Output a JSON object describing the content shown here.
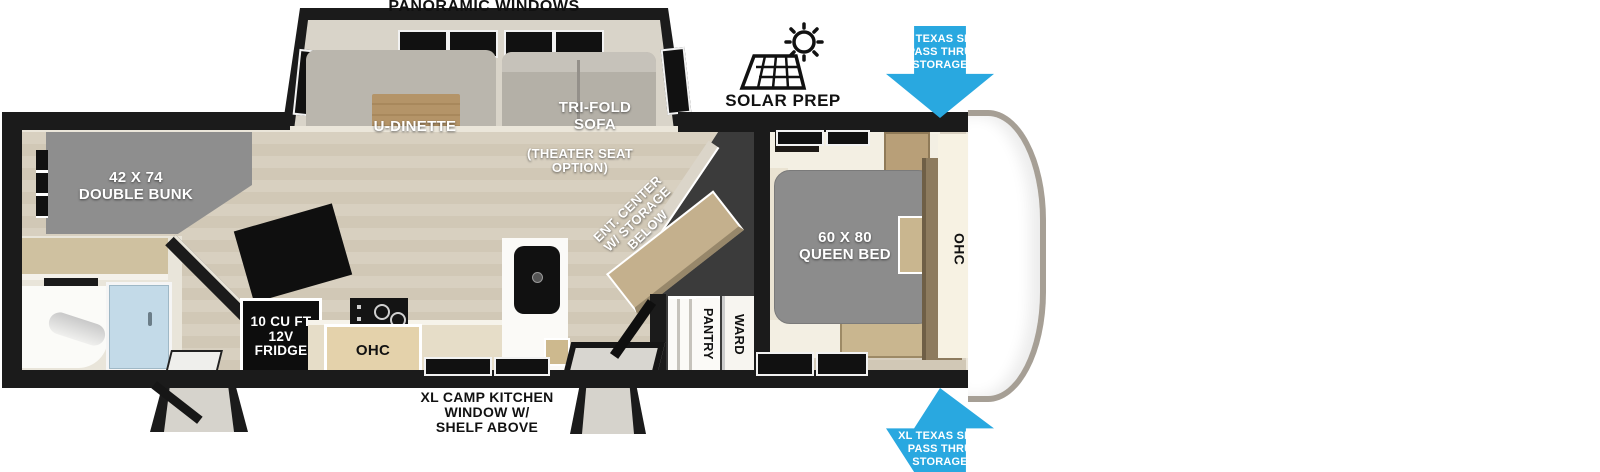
{
  "colors": {
    "accent_blue": "#29A8E0",
    "wall_black": "#1B1B1B",
    "furniture_gray": "#8C8C8C",
    "floor_beige": "#D8D0C0",
    "wood_tan": "#B49468",
    "dark_zone": "#3B3B3B",
    "shower_glass": "#C3DAE8"
  },
  "top": {
    "panoramic_windows": "PANORAMIC WINDOWS",
    "solar_prep": "SOLAR PREP"
  },
  "storage_arrows": {
    "top": {
      "lines": [
        "XL TEXAS SIZE",
        "PASS THRU",
        "STORAGE"
      ]
    },
    "bottom": {
      "lines": [
        "XL TEXAS SIZE",
        "PASS THRU",
        "STORAGE"
      ]
    }
  },
  "slideout": {
    "dinette": "U-DINETTE",
    "sofa": [
      "TRI-FOLD",
      "SOFA"
    ],
    "theater": [
      "(THEATER SEAT",
      "OPTION)"
    ]
  },
  "rear": {
    "bunk": [
      "42 X 74",
      "DOUBLE BUNK"
    ]
  },
  "kitchen": {
    "fridge": [
      "10 CU FT",
      "12V",
      "FRIDGE"
    ],
    "ohc": "OHC",
    "window_note": [
      "XL CAMP KITCHEN",
      "WINDOW W/",
      "SHELF ABOVE"
    ]
  },
  "center": {
    "ent_center": [
      "ENT. CENTER",
      "W/ STORAGE",
      "BELOW"
    ],
    "pantry": "PANTRY",
    "ward": "WARD"
  },
  "bedroom": {
    "bed": [
      "60 X 80",
      "QUEEN BED"
    ],
    "ohc": "OHC"
  }
}
